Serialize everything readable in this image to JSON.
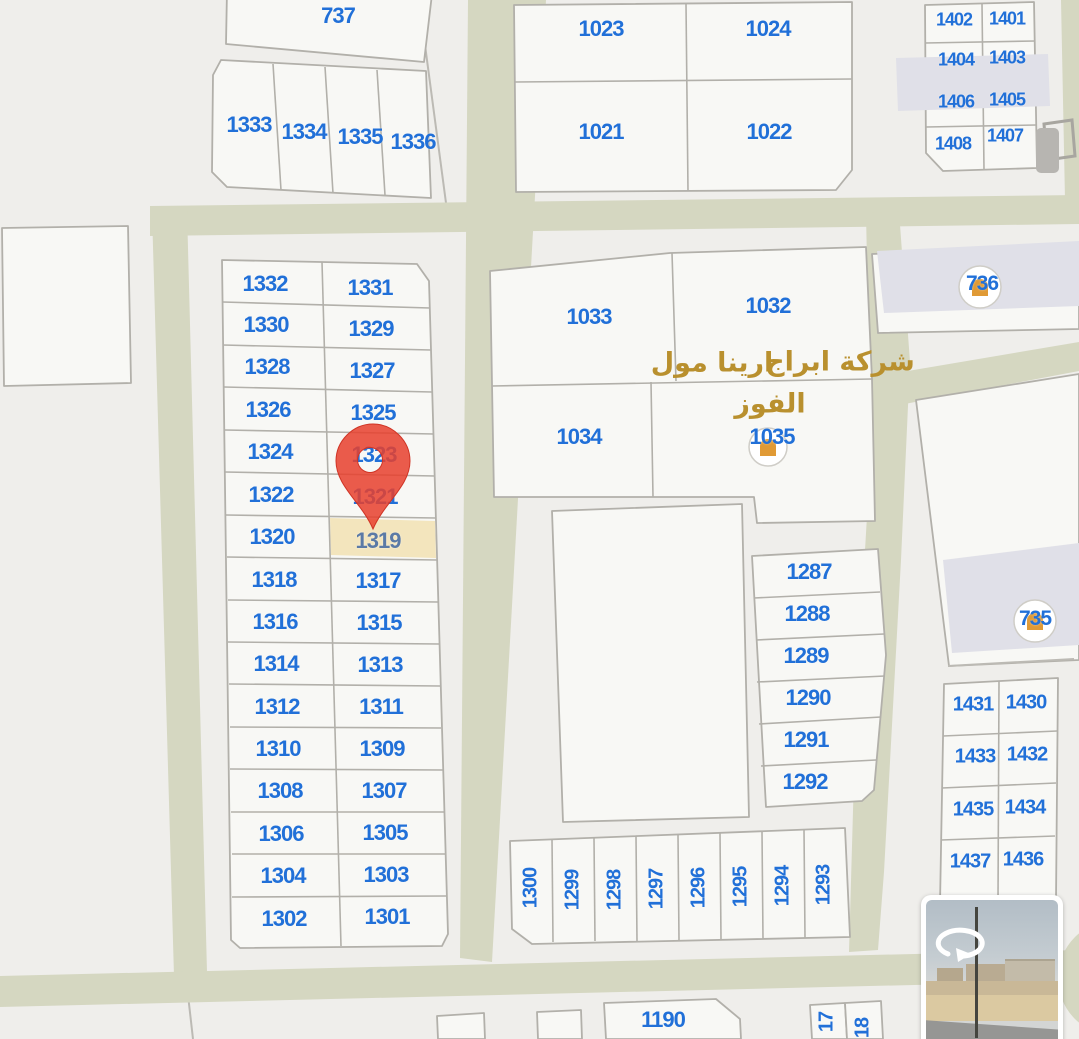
{
  "map": {
    "highlighted_parcel": "1319",
    "pin_target_parcel": "1319",
    "parcel_numbers": [
      "737",
      "1333",
      "1334",
      "1335",
      "1336",
      "1023",
      "1024",
      "1021",
      "1022",
      "1402",
      "1401",
      "1404",
      "1403",
      "1406",
      "1405",
      "1408",
      "1407",
      "1332",
      "1331",
      "1330",
      "1329",
      "1328",
      "1327",
      "1326",
      "1325",
      "1324",
      "1323",
      "1322",
      "1321",
      "1320",
      "1319",
      "1318",
      "1317",
      "1316",
      "1315",
      "1314",
      "1313",
      "1312",
      "1311",
      "1310",
      "1309",
      "1308",
      "1307",
      "1306",
      "1305",
      "1304",
      "1303",
      "1302",
      "1301",
      "1033",
      "1032",
      "1034",
      "1035",
      "736",
      "735",
      "1287",
      "1288",
      "1289",
      "1290",
      "1291",
      "1292",
      "1300",
      "1299",
      "1298",
      "1297",
      "1296",
      "1295",
      "1294",
      "1293",
      "1431",
      "1430",
      "1433",
      "1432",
      "1435",
      "1434",
      "1437",
      "1436",
      "1190",
      "17",
      "18"
    ],
    "area_label": {
      "part1": "ارينا مول",
      "part2": "شركة ابراج",
      "part3": "الفوز"
    }
  },
  "colors": {
    "background": "#efeeeb",
    "parcel_fill": "#f8f8f5",
    "parcel_border": "#b2b0aa",
    "road": "#d5d7c1",
    "parcel_number_blue": "#2170d8",
    "selected_parcel_text": "#5b7aa6",
    "highlight_fill": "#f3e5bd",
    "pin_red": "#e8402d",
    "area_label_gold": "#b9902e",
    "building_fill": "#e0e0e8",
    "poi_gold": "#e09a35"
  }
}
